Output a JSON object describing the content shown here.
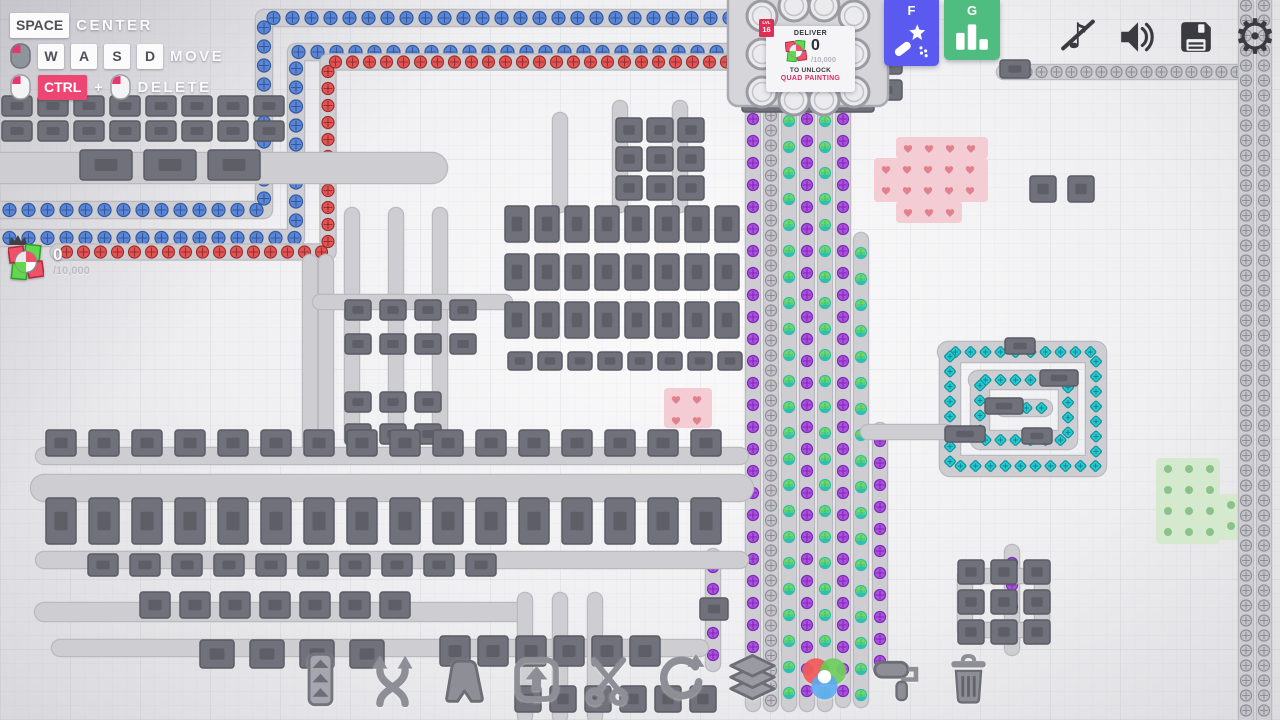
{
  "hotkeys": {
    "rows": [
      {
        "keys": [
          "SPACE"
        ],
        "label": "CENTER"
      },
      {
        "keys": [
          "W",
          "A",
          "S",
          "D"
        ],
        "label": "MOVE"
      },
      {
        "keys": [
          "CTRL"
        ],
        "plus": "+",
        "label": "DELETE"
      }
    ]
  },
  "goal": {
    "value": "0",
    "total": "/10,000"
  },
  "hub": {
    "level_label": "LVL",
    "level": "16",
    "deliver": "DELIVER",
    "amount": "0",
    "total": "/10,000",
    "unlock1": "TO UNLOCK",
    "unlock2": "QUAD PAINTING"
  },
  "quickbar": {
    "f": "F",
    "g": "G"
  },
  "system": {
    "music_glyph": "♪",
    "gear_glyph": "⚙"
  },
  "toolbar": {
    "items": [
      {
        "name": "conveyor"
      },
      {
        "name": "shuffle"
      },
      {
        "name": "shape-tool"
      },
      {
        "name": "lift"
      },
      {
        "name": "cutter"
      },
      {
        "name": "rotator"
      },
      {
        "name": "stacker"
      },
      {
        "name": "color-mixer"
      },
      {
        "name": "painter"
      },
      {
        "name": "delete"
      }
    ]
  },
  "colors": {
    "accent": "#e8356e",
    "f_button": "#5a5af0",
    "g_button": "#4fbd80",
    "icon_dark": "#3a3a40",
    "toolbar_icon": "#85858e",
    "item_blue": "#5b86d6",
    "item_red": "#e25555",
    "item_purple": "#ad4fe0",
    "item_green": "#7cd94f",
    "item_cyan": "#29cdd3",
    "item_gray": "#c3c3c9"
  },
  "map": {
    "hub": {
      "x": 728,
      "y": -8,
      "w": 160,
      "h": 114,
      "ports": [
        [
          762,
          16
        ],
        [
          762,
          54
        ],
        [
          762,
          92
        ],
        [
          854,
          16
        ],
        [
          854,
          54
        ],
        [
          854,
          92
        ],
        [
          794,
          6
        ],
        [
          824,
          6
        ],
        [
          794,
          100
        ],
        [
          824,
          100
        ]
      ]
    },
    "belts": [
      {
        "pts": [
          [
            0,
            210
          ],
          [
            264,
            210
          ],
          [
            264,
            18
          ],
          [
            742,
            18
          ]
        ],
        "item": "blue",
        "w": 16
      },
      {
        "pts": [
          [
            0,
            238
          ],
          [
            296,
            238
          ],
          [
            296,
            52
          ],
          [
            740,
            52
          ]
        ],
        "item": "blue",
        "w": 16
      },
      {
        "pts": [
          [
            58,
            252
          ],
          [
            328,
            252
          ],
          [
            328,
            62
          ],
          [
            738,
            62
          ]
        ],
        "item": "red",
        "w": 15
      },
      {
        "pts": [
          [
            1004,
            72
          ],
          [
            1238,
            72
          ]
        ],
        "item": "gray"
      },
      {
        "pts": [
          [
            1246,
            718
          ],
          [
            1246,
            2
          ]
        ],
        "item": "gray"
      },
      {
        "pts": [
          [
            1264,
            718
          ],
          [
            1264,
            2
          ]
        ],
        "item": "gray"
      },
      {
        "pts": [
          [
            753,
            108
          ],
          [
            753,
            704
          ]
        ],
        "item": "purple"
      },
      {
        "pts": [
          [
            771,
            108
          ],
          [
            771,
            704
          ]
        ],
        "item": "gray"
      },
      {
        "pts": [
          [
            789,
            108
          ],
          [
            789,
            704
          ]
        ],
        "item": "green"
      },
      {
        "pts": [
          [
            807,
            108
          ],
          [
            807,
            704
          ]
        ],
        "item": "purple"
      },
      {
        "pts": [
          [
            825,
            108
          ],
          [
            825,
            704
          ]
        ],
        "item": "green"
      },
      {
        "pts": [
          [
            843,
            108
          ],
          [
            843,
            700
          ]
        ],
        "item": "purple"
      },
      {
        "pts": [
          [
            861,
            240
          ],
          [
            861,
            700
          ]
        ],
        "item": "green"
      },
      {
        "pts": [
          [
            880,
            430
          ],
          [
            880,
            666
          ]
        ],
        "item": "purple"
      },
      {
        "pts": [
          [
            713,
            556
          ],
          [
            713,
            664
          ]
        ],
        "item": "purple"
      },
      {
        "pts": [
          [
            1012,
            552
          ],
          [
            1012,
            648
          ]
        ],
        "item": "purple"
      },
      {
        "pts": [
          [
            948,
            352
          ],
          [
            1096,
            352
          ],
          [
            1096,
            466
          ],
          [
            950,
            466
          ],
          [
            950,
            356
          ]
        ],
        "item": "cyan",
        "w": 20
      },
      {
        "pts": [
          [
            978,
            380
          ],
          [
            1068,
            380
          ],
          [
            1068,
            440
          ],
          [
            980,
            440
          ],
          [
            980,
            384
          ]
        ],
        "item": "cyan",
        "w": 18
      },
      {
        "pts": [
          [
            1004,
            408
          ],
          [
            1044,
            408
          ]
        ],
        "item": "cyan",
        "w": 16
      },
      {
        "pts": [
          [
            0,
            168
          ],
          [
            432,
            168
          ]
        ],
        "w": 30
      },
      {
        "pts": [
          [
            310,
            262
          ],
          [
            310,
            456
          ]
        ]
      },
      {
        "pts": [
          [
            326,
            262
          ],
          [
            326,
            456
          ]
        ]
      },
      {
        "pts": [
          [
            352,
            215
          ],
          [
            352,
            440
          ]
        ]
      },
      {
        "pts": [
          [
            396,
            215
          ],
          [
            396,
            440
          ]
        ]
      },
      {
        "pts": [
          [
            440,
            215
          ],
          [
            440,
            440
          ]
        ]
      },
      {
        "pts": [
          [
            320,
            302
          ],
          [
            505,
            302
          ]
        ]
      },
      {
        "pts": [
          [
            44,
            456
          ],
          [
            740,
            456
          ]
        ],
        "w": 16
      },
      {
        "pts": [
          [
            44,
            488
          ],
          [
            740,
            488
          ]
        ],
        "w": 26
      },
      {
        "pts": [
          [
            44,
            560
          ],
          [
            740,
            560
          ]
        ],
        "w": 16
      },
      {
        "pts": [
          [
            44,
            612
          ],
          [
            520,
            612
          ]
        ],
        "w": 18
      },
      {
        "pts": [
          [
            60,
            648
          ],
          [
            700,
            648
          ]
        ],
        "w": 16
      },
      {
        "pts": [
          [
            525,
            600
          ],
          [
            525,
            716
          ]
        ]
      },
      {
        "pts": [
          [
            560,
            600
          ],
          [
            560,
            716
          ]
        ]
      },
      {
        "pts": [
          [
            595,
            600
          ],
          [
            595,
            716
          ]
        ]
      },
      {
        "pts": [
          [
            868,
            432
          ],
          [
            946,
            432
          ]
        ]
      },
      {
        "pts": [
          [
            965,
            576
          ],
          [
            1042,
            576
          ],
          [
            1042,
            630
          ],
          [
            965,
            630
          ],
          [
            965,
            580
          ]
        ]
      },
      {
        "pts": [
          [
            560,
            120
          ],
          [
            560,
            205
          ]
        ]
      },
      {
        "pts": [
          [
            620,
            108
          ],
          [
            620,
            205
          ]
        ]
      },
      {
        "pts": [
          [
            680,
            108
          ],
          [
            680,
            205
          ]
        ]
      }
    ],
    "machines": [
      {
        "x": 2,
        "y": 96,
        "cw": 30,
        "ch": 20,
        "cols": 8,
        "rows": 2,
        "gx": 6,
        "gy": 5
      },
      {
        "x": 80,
        "y": 150,
        "cw": 52,
        "ch": 30,
        "cols": 3,
        "rows": 1,
        "gx": 12,
        "gy": 0
      },
      {
        "x": 616,
        "y": 118,
        "cw": 26,
        "ch": 24,
        "cols": 3,
        "rows": 3,
        "gx": 5,
        "gy": 5
      },
      {
        "x": 505,
        "y": 206,
        "cw": 24,
        "ch": 36,
        "cols": 8,
        "rows": 3,
        "gx": 6,
        "gy": 12
      },
      {
        "x": 508,
        "y": 352,
        "cw": 24,
        "ch": 18,
        "cols": 8,
        "rows": 1,
        "gx": 6,
        "gy": 0
      },
      {
        "x": 345,
        "y": 300,
        "cw": 26,
        "ch": 20,
        "cols": 4,
        "rows": 2,
        "gx": 9,
        "gy": 14
      },
      {
        "x": 345,
        "y": 392,
        "cw": 26,
        "ch": 20,
        "cols": 3,
        "rows": 2,
        "gx": 9,
        "gy": 12
      },
      {
        "x": 46,
        "y": 430,
        "cw": 30,
        "ch": 26,
        "cols": 16,
        "rows": 1,
        "gx": 13,
        "gy": 0
      },
      {
        "x": 46,
        "y": 498,
        "cw": 30,
        "ch": 46,
        "cols": 16,
        "rows": 1,
        "gx": 13,
        "gy": 0
      },
      {
        "x": 88,
        "y": 554,
        "cw": 30,
        "ch": 22,
        "cols": 10,
        "rows": 1,
        "gx": 12,
        "gy": 0
      },
      {
        "x": 140,
        "y": 592,
        "cw": 30,
        "ch": 26,
        "cols": 7,
        "rows": 1,
        "gx": 10,
        "gy": 0
      },
      {
        "x": 200,
        "y": 640,
        "cw": 34,
        "ch": 28,
        "cols": 4,
        "rows": 1,
        "gx": 16,
        "gy": 0
      },
      {
        "x": 440,
        "y": 636,
        "cw": 30,
        "ch": 30,
        "cols": 6,
        "rows": 1,
        "gx": 8,
        "gy": 0
      },
      {
        "x": 515,
        "y": 686,
        "cw": 26,
        "ch": 26,
        "cols": 6,
        "rows": 1,
        "gx": 9,
        "gy": 0
      },
      {
        "x": 958,
        "y": 560,
        "cw": 26,
        "ch": 24,
        "cols": 3,
        "rows": 3,
        "gx": 7,
        "gy": 6
      },
      {
        "x": 1030,
        "y": 176,
        "cw": 26,
        "ch": 26,
        "cols": 2,
        "rows": 1,
        "gx": 12,
        "gy": 0
      },
      {
        "x": 868,
        "y": 2,
        "cw": 34,
        "ch": 20,
        "cols": 1,
        "rows": 4,
        "gx": 0,
        "gy": 6
      },
      {
        "x": 742,
        "y": 96,
        "cw": 132,
        "ch": 16,
        "cols": 1,
        "rows": 1,
        "gx": 0,
        "gy": 0
      },
      {
        "x": 1005,
        "y": 338,
        "cw": 30,
        "ch": 16,
        "cols": 1,
        "rows": 1,
        "gx": 0,
        "gy": 0
      },
      {
        "x": 1040,
        "y": 370,
        "cw": 38,
        "ch": 16,
        "cols": 1,
        "rows": 1,
        "gx": 0,
        "gy": 0
      },
      {
        "x": 985,
        "y": 398,
        "cw": 38,
        "ch": 16,
        "cols": 1,
        "rows": 1,
        "gx": 0,
        "gy": 0
      },
      {
        "x": 945,
        "y": 426,
        "cw": 40,
        "ch": 16,
        "cols": 1,
        "rows": 1,
        "gx": 0,
        "gy": 0
      },
      {
        "x": 1022,
        "y": 428,
        "cw": 30,
        "ch": 16,
        "cols": 1,
        "rows": 1,
        "gx": 0,
        "gy": 0
      },
      {
        "x": 700,
        "y": 598,
        "cw": 28,
        "ch": 22,
        "cols": 1,
        "rows": 1,
        "gx": 0,
        "gy": 0
      },
      {
        "x": 1000,
        "y": 60,
        "cw": 30,
        "ch": 18,
        "cols": 1,
        "rows": 1,
        "gx": 0,
        "gy": 0
      }
    ],
    "patches": [
      {
        "bg": "#f3cdd3",
        "dot": "#e2808e",
        "shape": "heart",
        "rects": [
          [
            896,
            137,
            92,
            22
          ],
          [
            874,
            158,
            114,
            44
          ],
          [
            896,
            201,
            66,
            22
          ]
        ]
      },
      {
        "bg": "#f3cdd3",
        "dot": "#e2808e",
        "shape": "heart",
        "rects": [
          [
            664,
            388,
            48,
            40
          ]
        ]
      },
      {
        "bg": "#d5e9cf",
        "dot": "#8ac28a",
        "shape": "dot",
        "rects": [
          [
            1156,
            458,
            64,
            86
          ],
          [
            1219,
            494,
            24,
            46
          ]
        ]
      }
    ]
  }
}
